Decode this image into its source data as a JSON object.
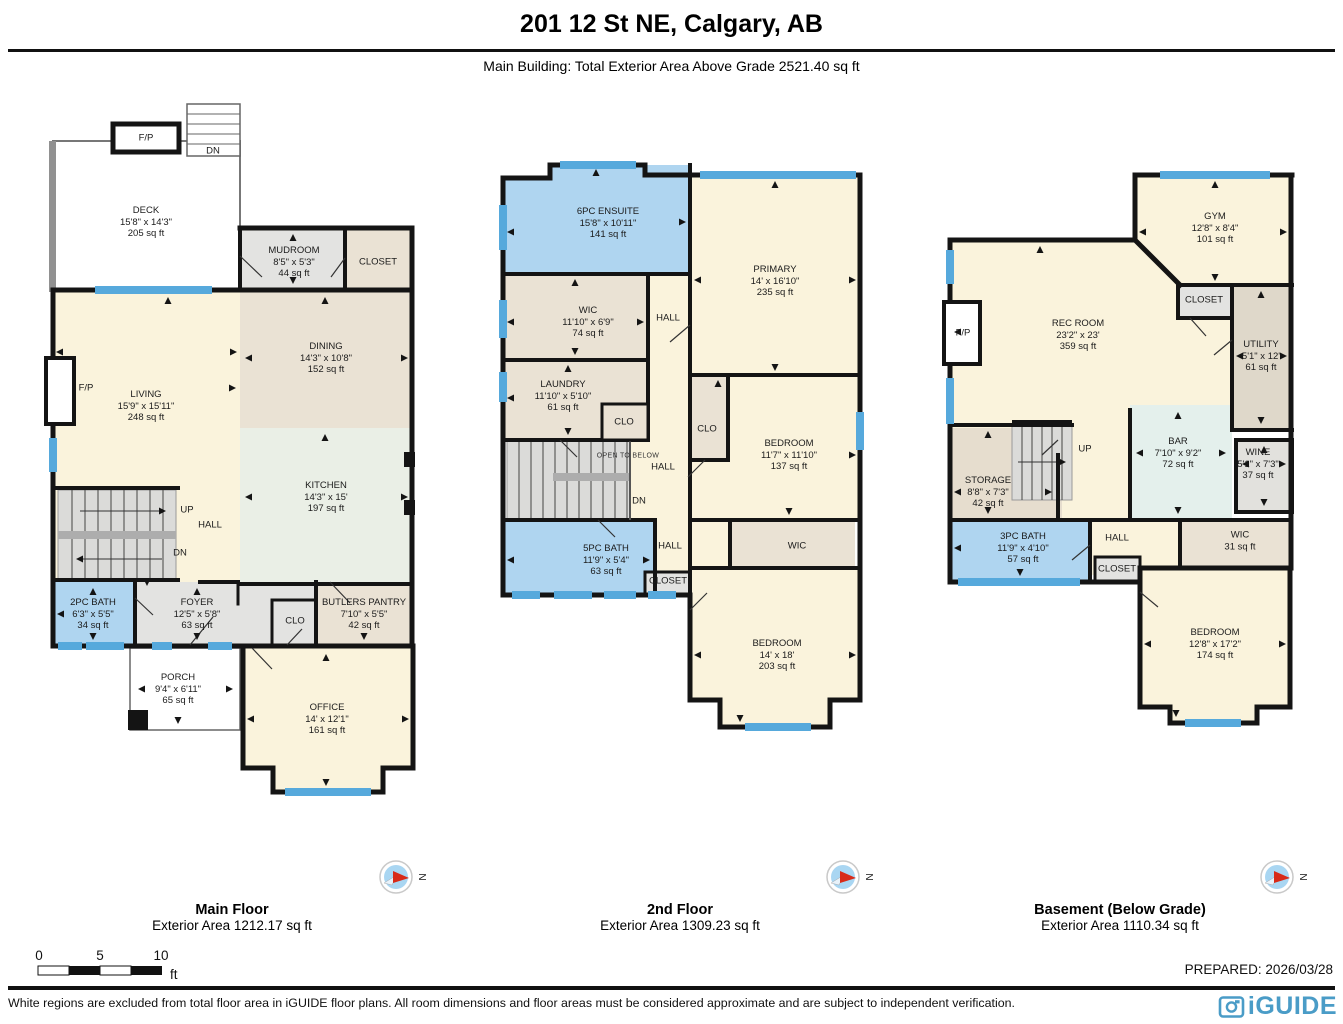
{
  "header": {
    "title": "201 12 St NE, Calgary, AB",
    "subtitle": "Main Building: Total Exterior Area Above Grade 2521.40 sq ft"
  },
  "floors": [
    {
      "title": "Main Floor",
      "area": "Exterior Area 1212.17 sq ft",
      "rooms": [
        {
          "name": "DECK",
          "dims": "15'8\" x 14'3\"",
          "area": "205 sq ft"
        },
        {
          "name": "MUDROOM",
          "dims": "8'5\" x 5'3\"",
          "area": "44 sq ft"
        },
        {
          "name": "CLOSET",
          "dims": "",
          "area": ""
        },
        {
          "name": "DINING",
          "dims": "14'3\" x 10'8\"",
          "area": "152 sq ft"
        },
        {
          "name": "LIVING",
          "dims": "15'9\" x 15'11\"",
          "area": "248 sq ft"
        },
        {
          "name": "KITCHEN",
          "dims": "14'3\" x 15'",
          "area": "197 sq ft"
        },
        {
          "name": "2PC BATH",
          "dims": "6'3\" x 5'5\"",
          "area": "34 sq ft"
        },
        {
          "name": "FOYER",
          "dims": "12'5\" x 5'8\"",
          "area": "63 sq ft"
        },
        {
          "name": "BUTLERS PANTRY",
          "dims": "7'10\" x 5'5\"",
          "area": "42 sq ft"
        },
        {
          "name": "PORCH",
          "dims": "9'4\" x 6'11\"",
          "area": "65 sq ft"
        },
        {
          "name": "OFFICE",
          "dims": "14' x 12'1\"",
          "area": "161 sq ft"
        }
      ],
      "notes": [
        "F/P",
        "DN",
        "F/P",
        "UP",
        "HALL",
        "DN",
        "CLO"
      ]
    },
    {
      "title": "2nd Floor",
      "area": "Exterior Area 1309.23 sq ft",
      "rooms": [
        {
          "name": "6PC ENSUITE",
          "dims": "15'8\" x 10'11\"",
          "area": "141 sq ft"
        },
        {
          "name": "PRIMARY",
          "dims": "14' x 16'10\"",
          "area": "235 sq ft"
        },
        {
          "name": "WIC",
          "dims": "11'10\" x 6'9\"",
          "area": "74 sq ft"
        },
        {
          "name": "LAUNDRY",
          "dims": "11'10\" x 5'10\"",
          "area": "61 sq ft"
        },
        {
          "name": "BEDROOM",
          "dims": "11'7\" x 11'10\"",
          "area": "137 sq ft"
        },
        {
          "name": "5PC BATH",
          "dims": "11'9\" x 5'4\"",
          "area": "63 sq ft"
        },
        {
          "name": "BEDROOM",
          "dims": "14' x 18'",
          "area": "203 sq ft"
        }
      ],
      "notes": [
        "HALL",
        "CLO",
        "CLO",
        "OPEN TO BELOW",
        "HALL",
        "DN",
        "HALL",
        "CLOSET",
        "WIC"
      ]
    },
    {
      "title": "Basement (Below Grade)",
      "area": "Exterior Area 1110.34 sq ft",
      "rooms": [
        {
          "name": "GYM",
          "dims": "12'8\" x 8'4\"",
          "area": "101 sq ft"
        },
        {
          "name": "REC ROOM",
          "dims": "23'2\" x 23'",
          "area": "359 sq ft"
        },
        {
          "name": "UTILITY",
          "dims": "5'1\" x 12'",
          "area": "61 sq ft"
        },
        {
          "name": "STORAGE",
          "dims": "8'8\" x 7'3\"",
          "area": "42 sq ft"
        },
        {
          "name": "BAR",
          "dims": "7'10\" x 9'2\"",
          "area": "72 sq ft"
        },
        {
          "name": "WINE",
          "dims": "5'1\" x 7'3\"",
          "area": "37 sq ft"
        },
        {
          "name": "3PC BATH",
          "dims": "11'9\" x 4'10\"",
          "area": "57 sq ft"
        },
        {
          "name": "WIC",
          "dims": "",
          "area": "31 sq ft"
        },
        {
          "name": "BEDROOM",
          "dims": "12'8\" x 17'2\"",
          "area": "174 sq ft"
        }
      ],
      "notes": [
        "F/P",
        "CLOSET",
        "UP",
        "HALL",
        "CLOSET"
      ]
    }
  ],
  "compass_n": "N",
  "scale": {
    "zero": "0",
    "five": "5",
    "ten": "10",
    "unit": "ft"
  },
  "footer": {
    "prepared": "PREPARED: 2026/03/28",
    "disclaimer": "White regions are excluded from total floor area in iGUIDE floor plans. All room dimensions and floor areas must be considered approximate and are subject to independent verification.",
    "logo_text": "iGUIDE"
  },
  "colors": {
    "wall": "#141414",
    "window": "#56A9DC",
    "cream": "#FAF3DC",
    "tan": "#EAE2D4",
    "grey": "#E3E3E1",
    "kitchen_green": "#EAEFE6",
    "bath_blue": "#AFD5F0",
    "bar_aqua": "#E4F0EC",
    "logo_blue": "#4A9CC7",
    "compass_red": "#D82A18"
  }
}
